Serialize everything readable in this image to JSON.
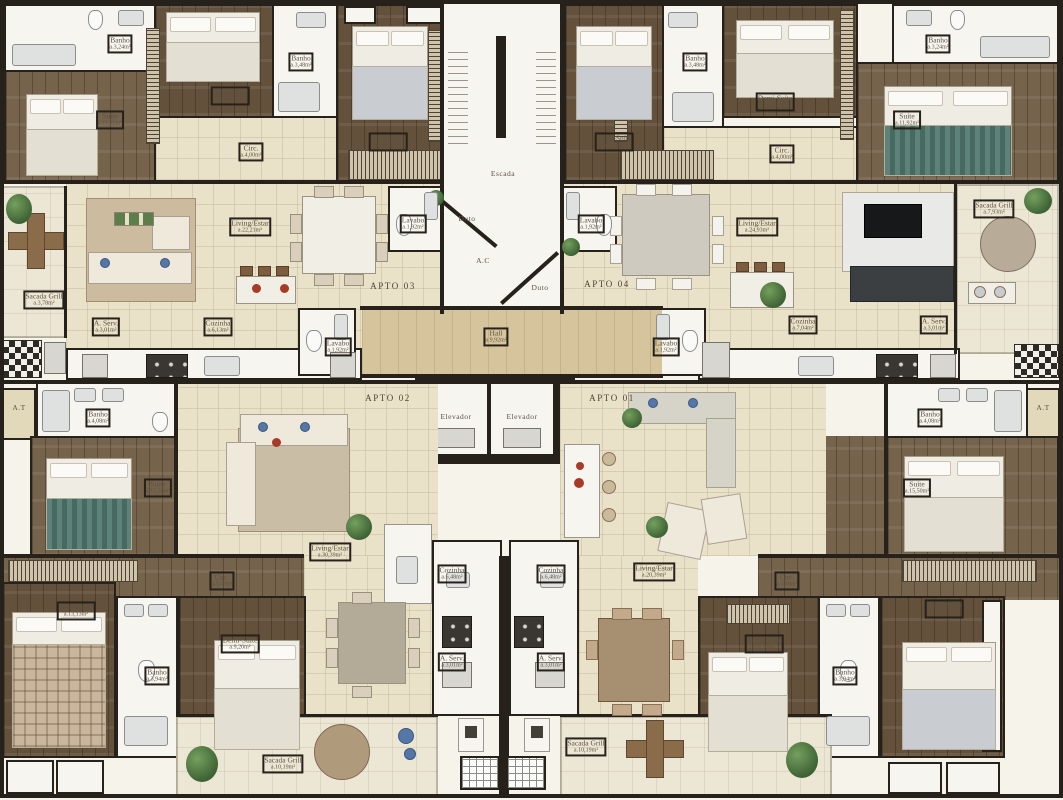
{
  "plan_title": "Residential floor plan",
  "units": [
    "APTO 01",
    "APTO 02",
    "APTO 03",
    "APTO 04"
  ],
  "core_spaces": [
    "Escada",
    "Elevador",
    "Hall",
    "A.C",
    "Duto",
    "A.T"
  ],
  "palette": {
    "wall": "#26211a",
    "wood": "#75634c",
    "tile": "#e9e1c8",
    "hall": "#d6c49c",
    "white_room": "#f6f5f0",
    "balcony": "#ece6d4",
    "label": "#5d5343",
    "accent_red": "#a83a28",
    "plant_green": "#4a7340",
    "teal_bed": "#5c8279"
  },
  "labels": [
    {
      "name": "Banho",
      "area": "a.3,24m²",
      "x": 120,
      "y": 44,
      "kind": "room"
    },
    {
      "name": "Suíte",
      "area": "a.11,92m²",
      "x": 110,
      "y": 120,
      "kind": "room"
    },
    {
      "name": "Demi-Suíte",
      "area": "a.8,58m²",
      "x": 230,
      "y": 96,
      "kind": "room"
    },
    {
      "name": "Banho",
      "area": "a.3,48m²",
      "x": 301,
      "y": 62,
      "kind": "room"
    },
    {
      "name": "Demi-Suíte",
      "area": "a.9,15m²",
      "x": 388,
      "y": 142,
      "kind": "room"
    },
    {
      "name": "Circ.",
      "area": "a.4,00m²",
      "x": 251,
      "y": 152,
      "kind": "room"
    },
    {
      "name": "A.T",
      "x": 390,
      "y": 15,
      "kind": "core"
    },
    {
      "name": "A.T",
      "x": 610,
      "y": 15,
      "kind": "core"
    },
    {
      "name": "Escada",
      "x": 503,
      "y": 174,
      "kind": "core"
    },
    {
      "name": "Demi-Suíte",
      "area": "a.9,15m²",
      "x": 614,
      "y": 142,
      "kind": "room"
    },
    {
      "name": "Banho",
      "area": "a.3,48m²",
      "x": 695,
      "y": 62,
      "kind": "room"
    },
    {
      "name": "Demi-Suíte",
      "area": "a.8,58m²",
      "x": 775,
      "y": 102,
      "kind": "room"
    },
    {
      "name": "Banho",
      "area": "a.3,24m²",
      "x": 938,
      "y": 44,
      "kind": "room"
    },
    {
      "name": "Suíte",
      "area": "a.11,92m²",
      "x": 907,
      "y": 120,
      "kind": "room"
    },
    {
      "name": "Circ.",
      "area": "a.4,00m²",
      "x": 782,
      "y": 154,
      "kind": "room"
    },
    {
      "name": "Sacada Grill",
      "area": "a.3,78m²",
      "x": 44,
      "y": 300,
      "kind": "room"
    },
    {
      "name": "Living/Estar",
      "area": "a.22,21m²",
      "x": 250,
      "y": 227,
      "kind": "room"
    },
    {
      "name": "Lavabo",
      "area": "a.1,92m²",
      "x": 413,
      "y": 224,
      "kind": "room"
    },
    {
      "name": "Duto",
      "x": 467,
      "y": 219,
      "kind": "core"
    },
    {
      "name": "A.C",
      "x": 483,
      "y": 261,
      "kind": "core"
    },
    {
      "name": "Duto",
      "x": 540,
      "y": 288,
      "kind": "core"
    },
    {
      "name": "Lavabo",
      "area": "a.1,92m²",
      "x": 591,
      "y": 224,
      "kind": "room"
    },
    {
      "name": "Living/Estar",
      "area": "a.24,93m²",
      "x": 757,
      "y": 227,
      "kind": "room"
    },
    {
      "name": "APTO 03",
      "x": 393,
      "y": 286,
      "kind": "unit"
    },
    {
      "name": "APTO 04",
      "x": 607,
      "y": 284,
      "kind": "unit"
    },
    {
      "name": "A. Serv.",
      "area": "a.3,01m²",
      "x": 106,
      "y": 327,
      "kind": "room"
    },
    {
      "name": "Cozinha",
      "area": "a.6,13m²",
      "x": 218,
      "y": 327,
      "kind": "room"
    },
    {
      "name": "Lavabo",
      "area": "a.1,92m²",
      "x": 338,
      "y": 347,
      "kind": "room"
    },
    {
      "name": "Hall",
      "area": "a.9,92m²",
      "x": 496,
      "y": 337,
      "kind": "room"
    },
    {
      "name": "Lavabo",
      "area": "a.1,92m²",
      "x": 666,
      "y": 347,
      "kind": "room"
    },
    {
      "name": "Cozinha",
      "area": "a.7,04m²",
      "x": 803,
      "y": 325,
      "kind": "room"
    },
    {
      "name": "A. Serv.",
      "area": "a.3,01m²",
      "x": 934,
      "y": 325,
      "kind": "room"
    },
    {
      "name": "Sacada Grill",
      "area": "a.7,93m²",
      "x": 994,
      "y": 209,
      "kind": "room"
    },
    {
      "name": "Elevador",
      "x": 456,
      "y": 417,
      "kind": "core"
    },
    {
      "name": "Elevador",
      "x": 522,
      "y": 417,
      "kind": "core"
    },
    {
      "name": "APTO 02",
      "x": 388,
      "y": 398,
      "kind": "unit"
    },
    {
      "name": "APTO 01",
      "x": 612,
      "y": 398,
      "kind": "unit"
    },
    {
      "name": "A.T",
      "x": 19,
      "y": 408,
      "kind": "core"
    },
    {
      "name": "Banho",
      "area": "a.4,08m²",
      "x": 98,
      "y": 418,
      "kind": "room"
    },
    {
      "name": "Suíte",
      "area": "a.15,50m²",
      "x": 158,
      "y": 488,
      "kind": "room"
    },
    {
      "name": "Circ.",
      "area": "a.3,00m²",
      "x": 222,
      "y": 581,
      "kind": "room"
    },
    {
      "name": "Living/Estar",
      "area": "a.30,39m²",
      "x": 330,
      "y": 552,
      "kind": "room"
    },
    {
      "name": "Cozinha",
      "area": "a.6,48m²",
      "x": 452,
      "y": 574,
      "kind": "room"
    },
    {
      "name": "A. Serv.",
      "area": "a.3,01m²",
      "x": 452,
      "y": 662,
      "kind": "room"
    },
    {
      "name": "Demi-Suíte",
      "area": "a.13,13m²",
      "x": 76,
      "y": 611,
      "kind": "room"
    },
    {
      "name": "Banho",
      "area": "a.3,94m²",
      "x": 157,
      "y": 676,
      "kind": "room"
    },
    {
      "name": "Demi-Suíte",
      "area": "a.9,20m²",
      "x": 240,
      "y": 644,
      "kind": "room"
    },
    {
      "name": "Sacada Grill",
      "area": "a.10,19m²",
      "x": 283,
      "y": 764,
      "kind": "room"
    },
    {
      "name": "Banho",
      "area": "a.4,08m²",
      "x": 930,
      "y": 418,
      "kind": "room"
    },
    {
      "name": "A.T",
      "x": 1043,
      "y": 408,
      "kind": "core"
    },
    {
      "name": "Suíte",
      "area": "a.15,50m²",
      "x": 917,
      "y": 488,
      "kind": "room"
    },
    {
      "name": "Circ.",
      "area": "a.3,00m²",
      "x": 787,
      "y": 581,
      "kind": "room"
    },
    {
      "name": "Living/Estar",
      "area": "a.20,39m²",
      "x": 654,
      "y": 572,
      "kind": "room"
    },
    {
      "name": "Cozinha",
      "area": "a.6,48m²",
      "x": 551,
      "y": 574,
      "kind": "room"
    },
    {
      "name": "A. Serv.",
      "area": "a.3,01m²",
      "x": 551,
      "y": 662,
      "kind": "room"
    },
    {
      "name": "Demi-Suíte",
      "area": "a.9,20m²",
      "x": 764,
      "y": 644,
      "kind": "room"
    },
    {
      "name": "Banho",
      "area": "a.3,94m²",
      "x": 845,
      "y": 676,
      "kind": "room"
    },
    {
      "name": "Demi-Suíte",
      "area": "a.12,13m²",
      "x": 944,
      "y": 609,
      "kind": "room"
    },
    {
      "name": "Sacada Grill",
      "area": "a.10,19m²",
      "x": 586,
      "y": 747,
      "kind": "room"
    }
  ]
}
